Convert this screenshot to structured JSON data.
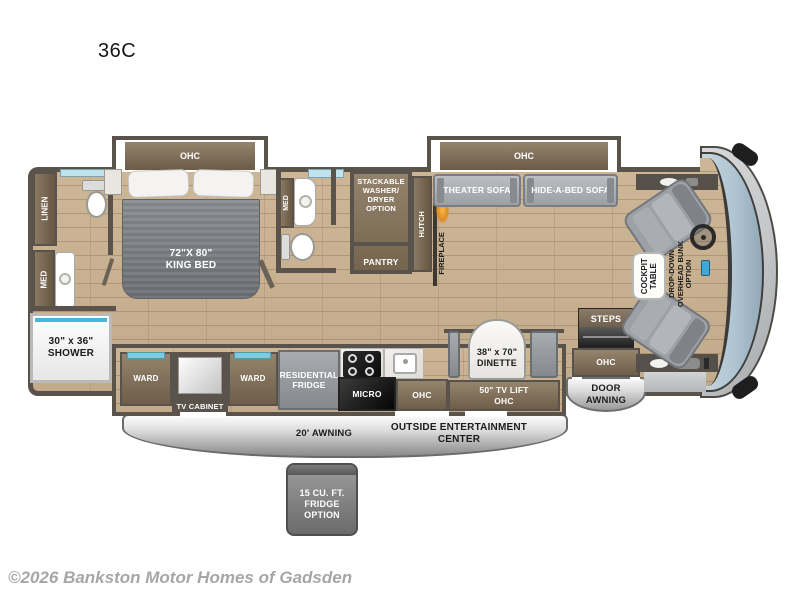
{
  "title": "36C",
  "copyright": "©2026 Bankston Motor Homes of Gadsden",
  "colors": {
    "wall": "#59534B",
    "cabinet_brown": "#8A7962",
    "floor_wood": "#C9B292",
    "furniture_gray": "#A4A8AC",
    "windshield_glass": "#AFC4D2",
    "window_cyan": "#7ECBE0",
    "fireplace_glow": "#F3A63D",
    "awning_gray": "#C9C9C9"
  },
  "bedroom": {
    "ohc": "OHC",
    "bed_size": "72\"X 80\"",
    "bed_name": "KING BED"
  },
  "rear_bath": {
    "linen": "LINEN",
    "med": "MED",
    "shower_size": "30\" x 36\"",
    "shower_name": "SHOWER"
  },
  "mid_bath": {
    "med": "MED"
  },
  "utility": {
    "washer_l1": "STACKABLE",
    "washer_l2": "WASHER/",
    "washer_l3": "DRYER",
    "washer_l4": "OPTION",
    "pantry": "PANTRY",
    "hutch": "HUTCH",
    "fireplace": "FIREPLACE"
  },
  "living": {
    "ohc": "OHC",
    "theater_sofa": "THEATER SOFA",
    "hide_a_bed_sofa": "HIDE-A-BED SOFA"
  },
  "kitchen": {
    "ward_left": "WARD",
    "tv_cabinet": "TV CABINET",
    "ward_right": "WARD",
    "fridge_l1": "RESIDENTIAL",
    "fridge_l2": "FRIDGE",
    "micro": "MICRO",
    "ohc": "OHC"
  },
  "dinette": {
    "size": "38\" x 70\"",
    "name": "DINETTE",
    "tv_lift_l1": "50\" TV LIFT",
    "tv_lift_l2": "OHC"
  },
  "cockpit": {
    "table_l1": "COCKPIT",
    "table_l2": "TABLE",
    "bunk_l1": "DROP-DOWN",
    "bunk_l2": "OVERHEAD BUNK",
    "bunk_l3": "OPTION",
    "steps": "STEPS",
    "ohc": "OHC"
  },
  "exterior": {
    "door_awning_l1": "DOOR",
    "door_awning_l2": "AWNING",
    "awning": "20' AWNING",
    "entertainment_l1": "OUTSIDE ENTERTAINMENT",
    "entertainment_l2": "CENTER",
    "fridge_option_l1": "15 CU. FT.",
    "fridge_option_l2": "FRIDGE",
    "fridge_option_l3": "OPTION"
  }
}
